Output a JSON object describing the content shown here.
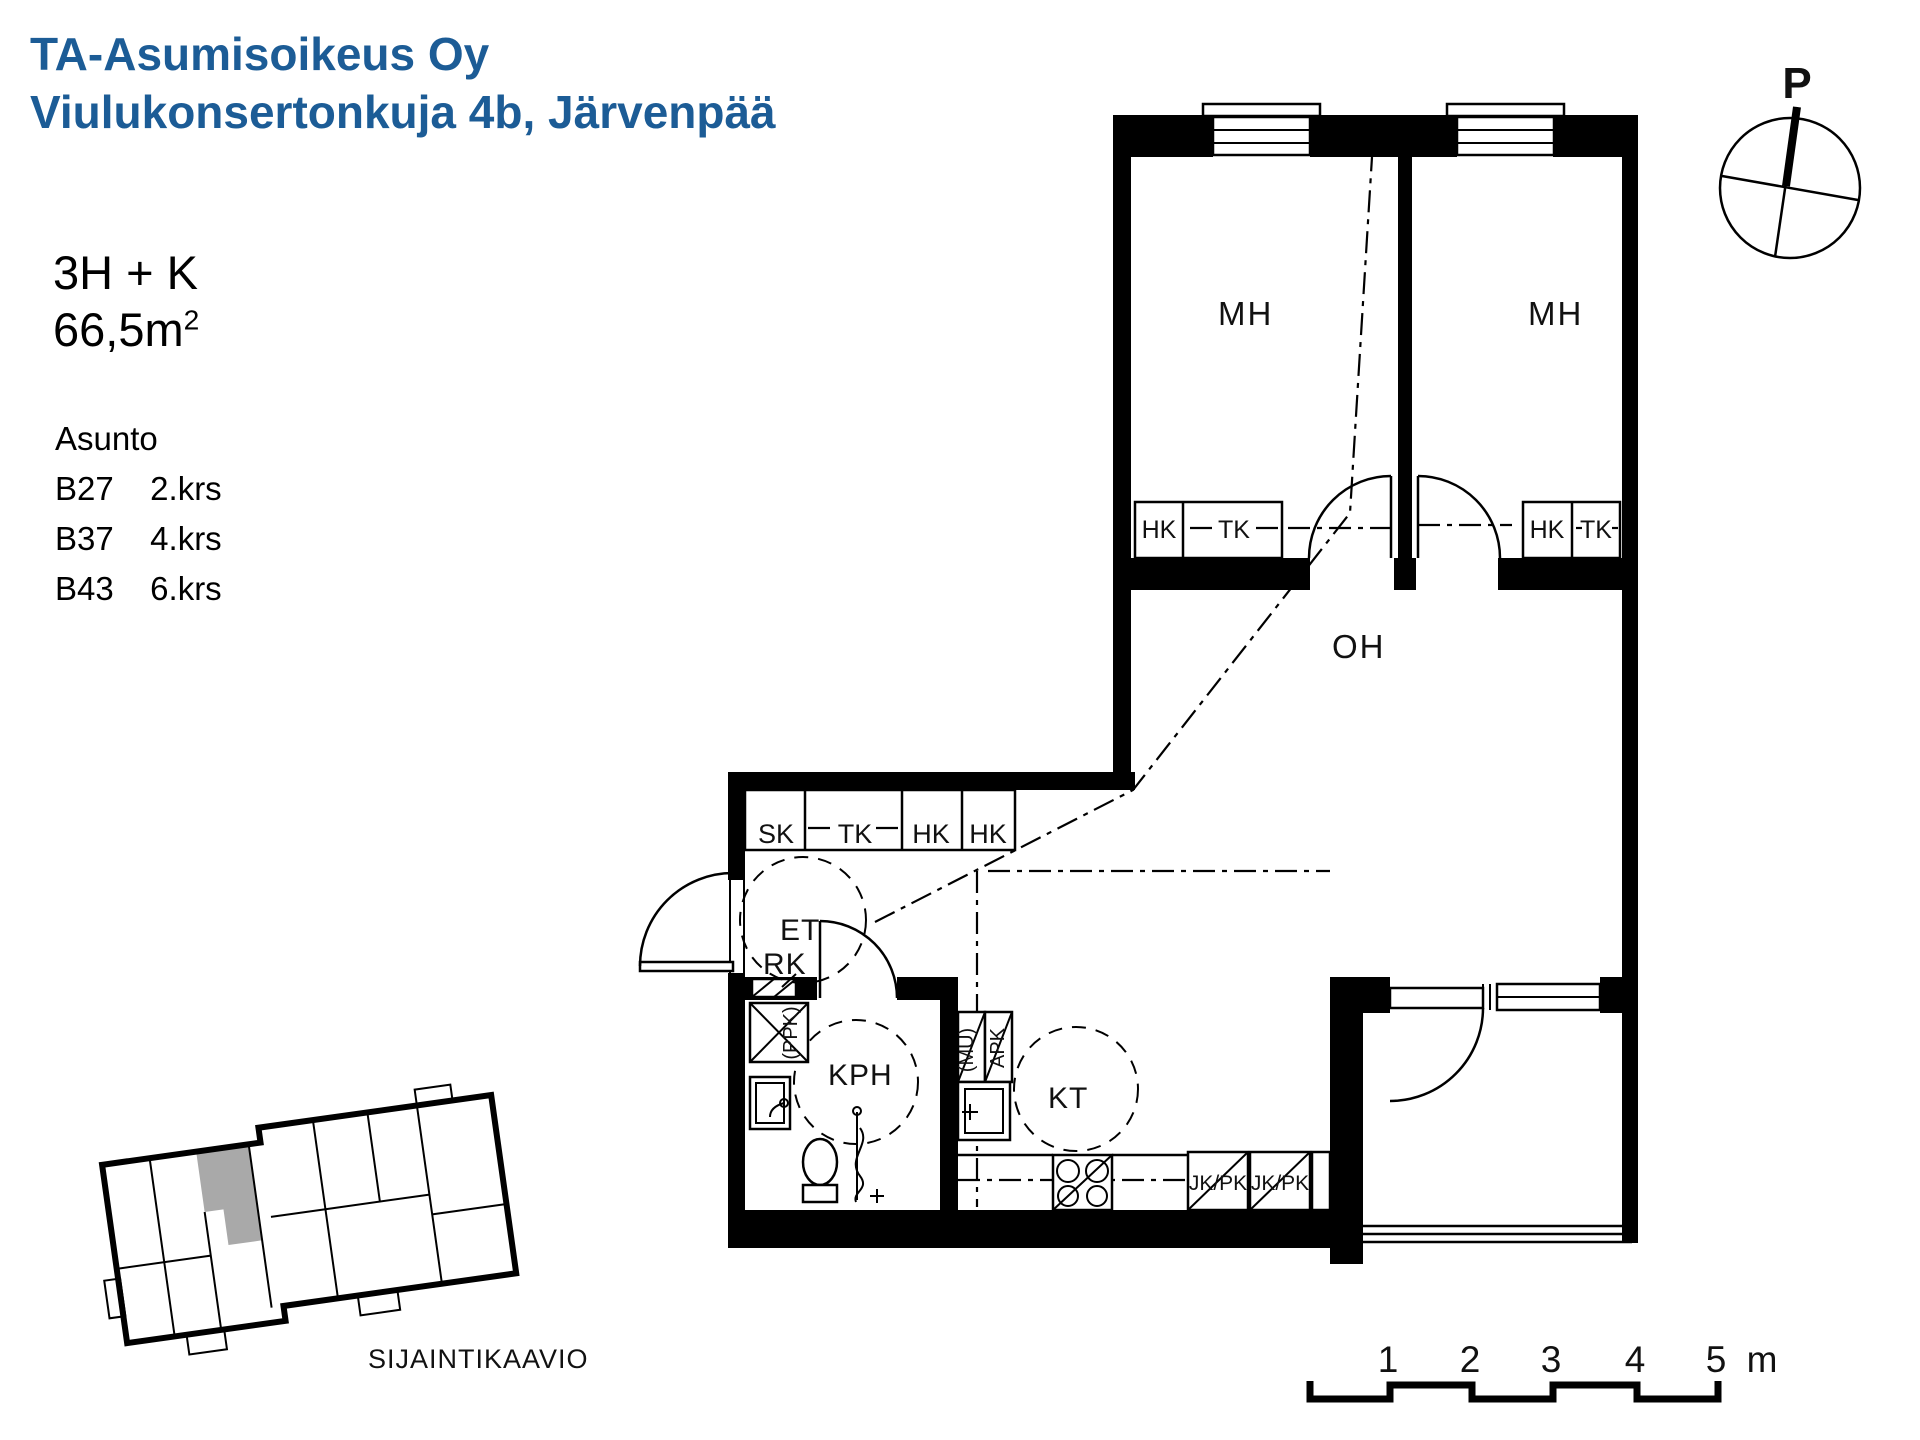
{
  "header": {
    "line1": "TA-Asumisoikeus Oy",
    "line2": "Viulukonsertonkuja 4b, Järvenpää",
    "color": "#1c5c96"
  },
  "apartment": {
    "type": "3H + K",
    "area": "66,5m",
    "area_sup": "2"
  },
  "units": {
    "heading": "Asunto",
    "rows": [
      {
        "id": "B27",
        "floor": "2.krs"
      },
      {
        "id": "B37",
        "floor": "4.krs"
      },
      {
        "id": "B43",
        "floor": "6.krs"
      }
    ]
  },
  "compass": {
    "north_label": "P"
  },
  "plan": {
    "mh1": "MH",
    "mh2": "MH",
    "oh": "OH",
    "et": "ET",
    "kph": "KPH",
    "kt": "KT",
    "rk": "RK",
    "ppk": "(PPK)",
    "mu": "(MU)",
    "apk": "APK",
    "jkpk": "JK/PK",
    "entry_closets": [
      "SK",
      "TK",
      "HK",
      "HK"
    ],
    "mh1_closets": [
      "HK",
      "TK"
    ],
    "mh2_closets": [
      "HK",
      "TK"
    ]
  },
  "location": {
    "caption": "SIJAINTIKAAVIO",
    "highlight_color": "#a9a9a9"
  },
  "scale": {
    "ticks": [
      "1",
      "2",
      "3",
      "4",
      "5"
    ],
    "unit": "m"
  }
}
